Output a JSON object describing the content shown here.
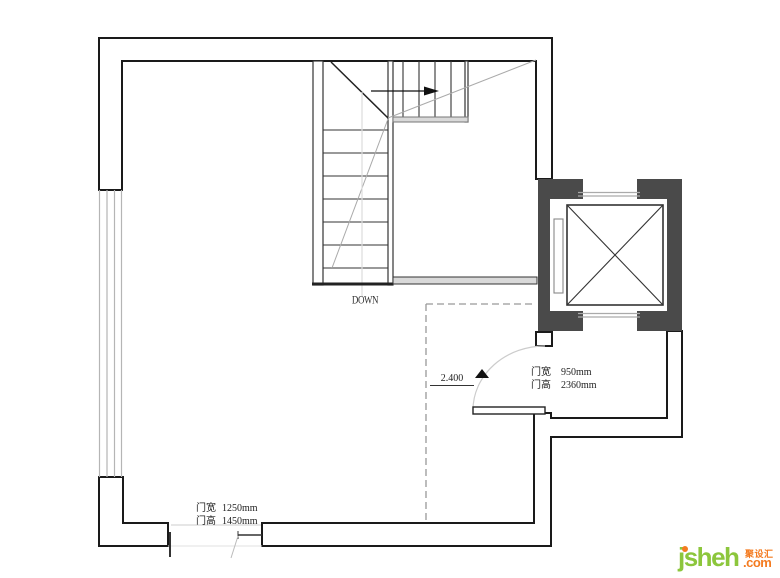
{
  "plan": {
    "stairs": {
      "down_label": "DOWN"
    },
    "level_marker": {
      "value": "2.400"
    },
    "door_right": {
      "width_label": "门宽",
      "width_value": "950mm",
      "height_label": "门高",
      "height_value": "2360mm"
    },
    "door_bottom": {
      "width_label": "门宽",
      "width_value": "1250mm",
      "height_label": "门高",
      "height_value": "1450mm"
    }
  },
  "watermark": {
    "brand": "jsheh",
    "tld": ".com",
    "cn": "聚设汇",
    "brand_color": "#8CC63C",
    "accent_color": "#F47B20"
  },
  "colors": {
    "wall_line": "#1a1a1a",
    "shaft_fill": "#4a4a4a",
    "dash_line": "#999999",
    "thin_gray": "#bbbbbb"
  }
}
